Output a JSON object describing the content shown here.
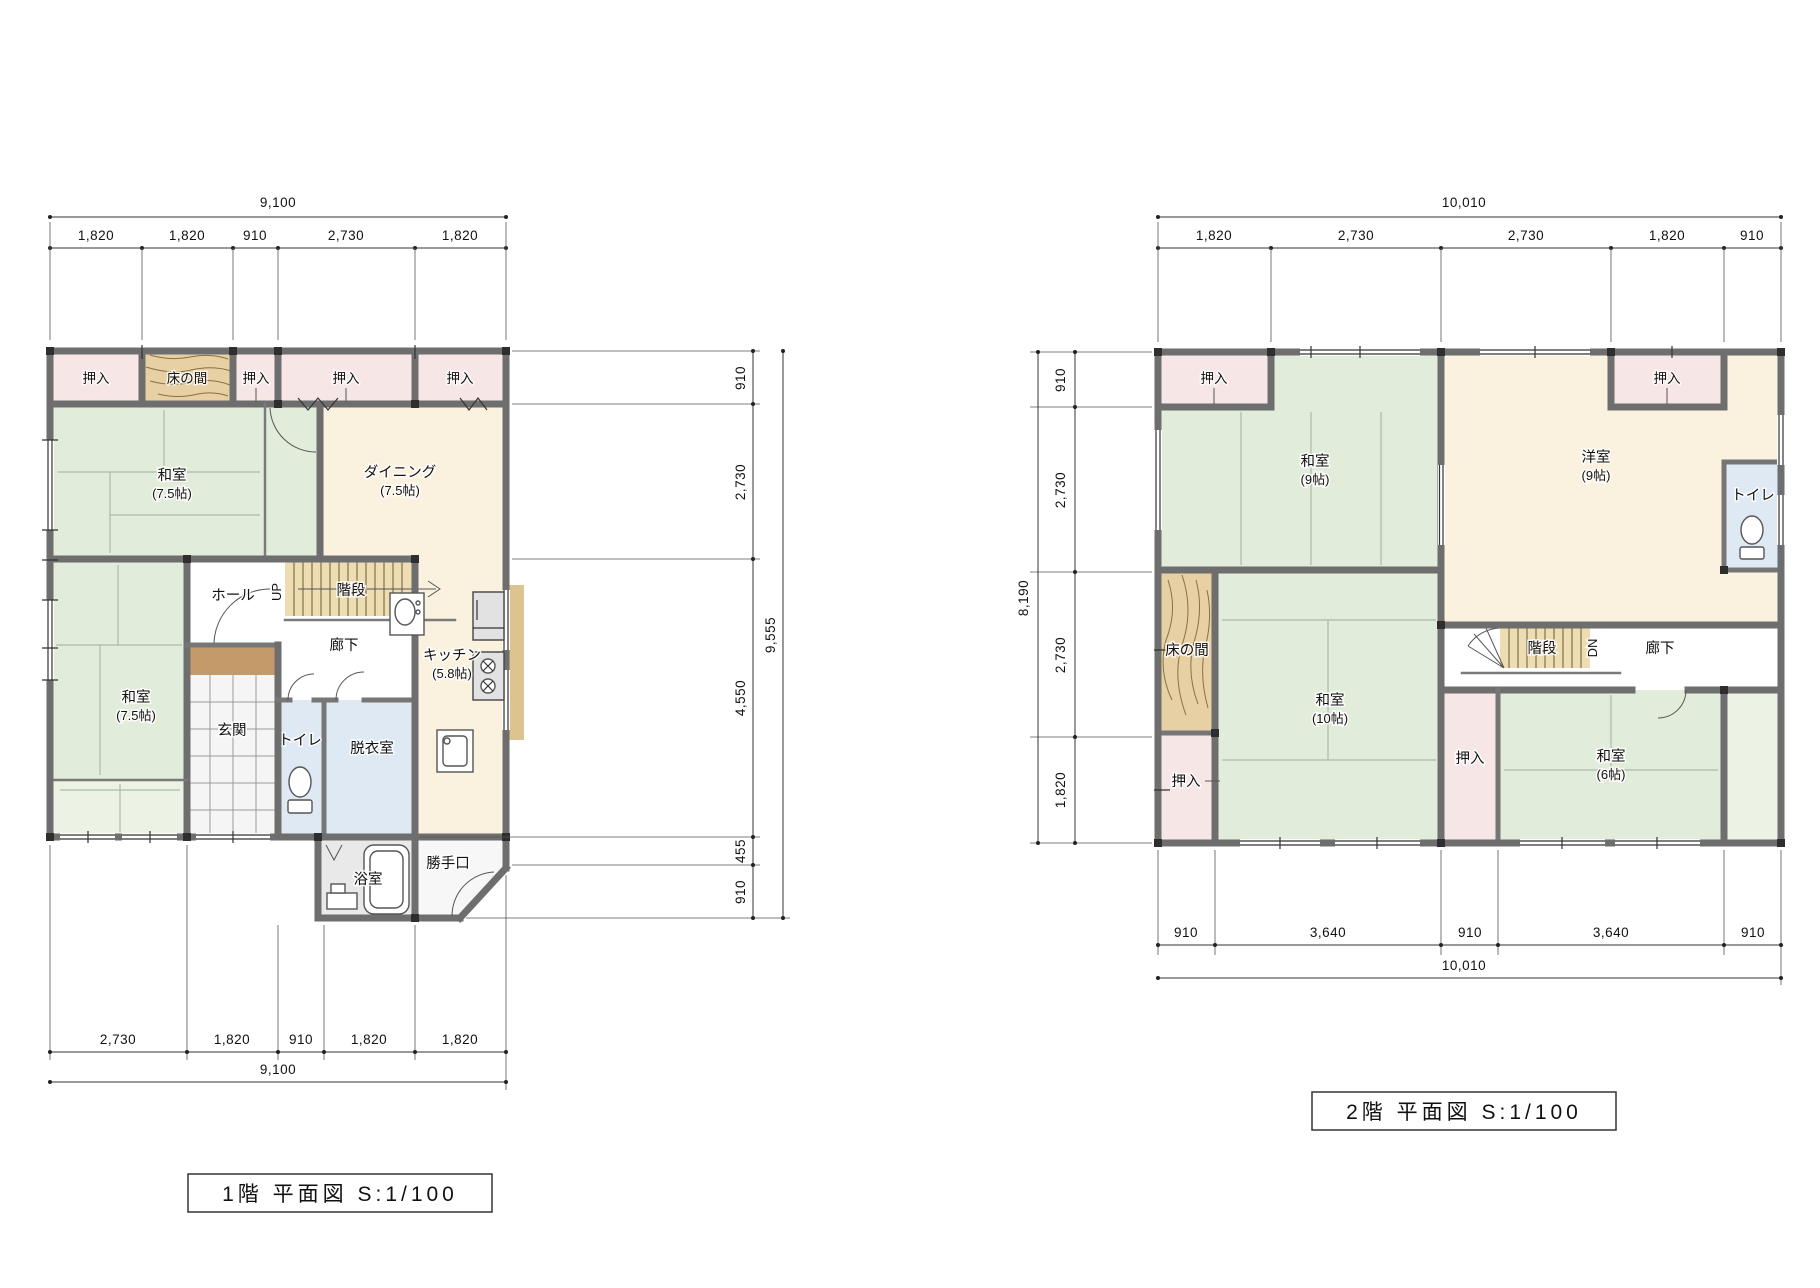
{
  "floor1": {
    "title": "1階 平面図 S:1/100",
    "dims": {
      "top_total": "9,100",
      "top": [
        "1,820",
        "1,820",
        "910",
        "2,730",
        "1,820"
      ],
      "right": [
        "910",
        "2,730",
        "4,550",
        "455",
        "910"
      ],
      "right_total": "9,555",
      "bottom": [
        "2,730",
        "1,820",
        "910",
        "1,820",
        "1,820"
      ],
      "bottom_total": "9,100"
    },
    "rooms": {
      "oshiire": "押入",
      "tokonoma": "床の間",
      "washitsu_a": "和室",
      "washitsu_a_size": "(7.5帖)",
      "washitsu_b": "和室",
      "washitsu_b_size": "(7.5帖)",
      "dining": "ダイニング",
      "dining_size": "(7.5帖)",
      "kitchen": "キッチン",
      "kitchen_size": "(5.8帖)",
      "kaidan": "階段",
      "up": "UP",
      "hall": "ホール",
      "rouka": "廊下",
      "genkan": "玄関",
      "toilet": "トイレ",
      "datsuishitsu": "脱衣室",
      "yokushitsu": "浴室",
      "katteguchi": "勝手口"
    }
  },
  "floor2": {
    "title": "2階 平面図 S:1/100",
    "dims": {
      "top_total": "10,010",
      "top": [
        "1,820",
        "2,730",
        "2,730",
        "1,820",
        "910"
      ],
      "left": [
        "910",
        "2,730",
        "2,730",
        "1,820"
      ],
      "left_total": "8,190",
      "bottom": [
        "910",
        "3,640",
        "910",
        "3,640",
        "910"
      ],
      "bottom_total": "10,010"
    },
    "rooms": {
      "oshiire": "押入",
      "tokonoma": "床の間",
      "washitsu_9": "和室",
      "washitsu_9_size": "(9帖)",
      "youshitsu": "洋室",
      "youshitsu_size": "(9帖)",
      "washitsu_10": "和室",
      "washitsu_10_size": "(10帖)",
      "washitsu_6": "和室",
      "washitsu_6_size": "(6帖)",
      "toilet": "トイレ",
      "rouka": "廊下",
      "kaidan": "階段",
      "dn": "DN"
    }
  }
}
